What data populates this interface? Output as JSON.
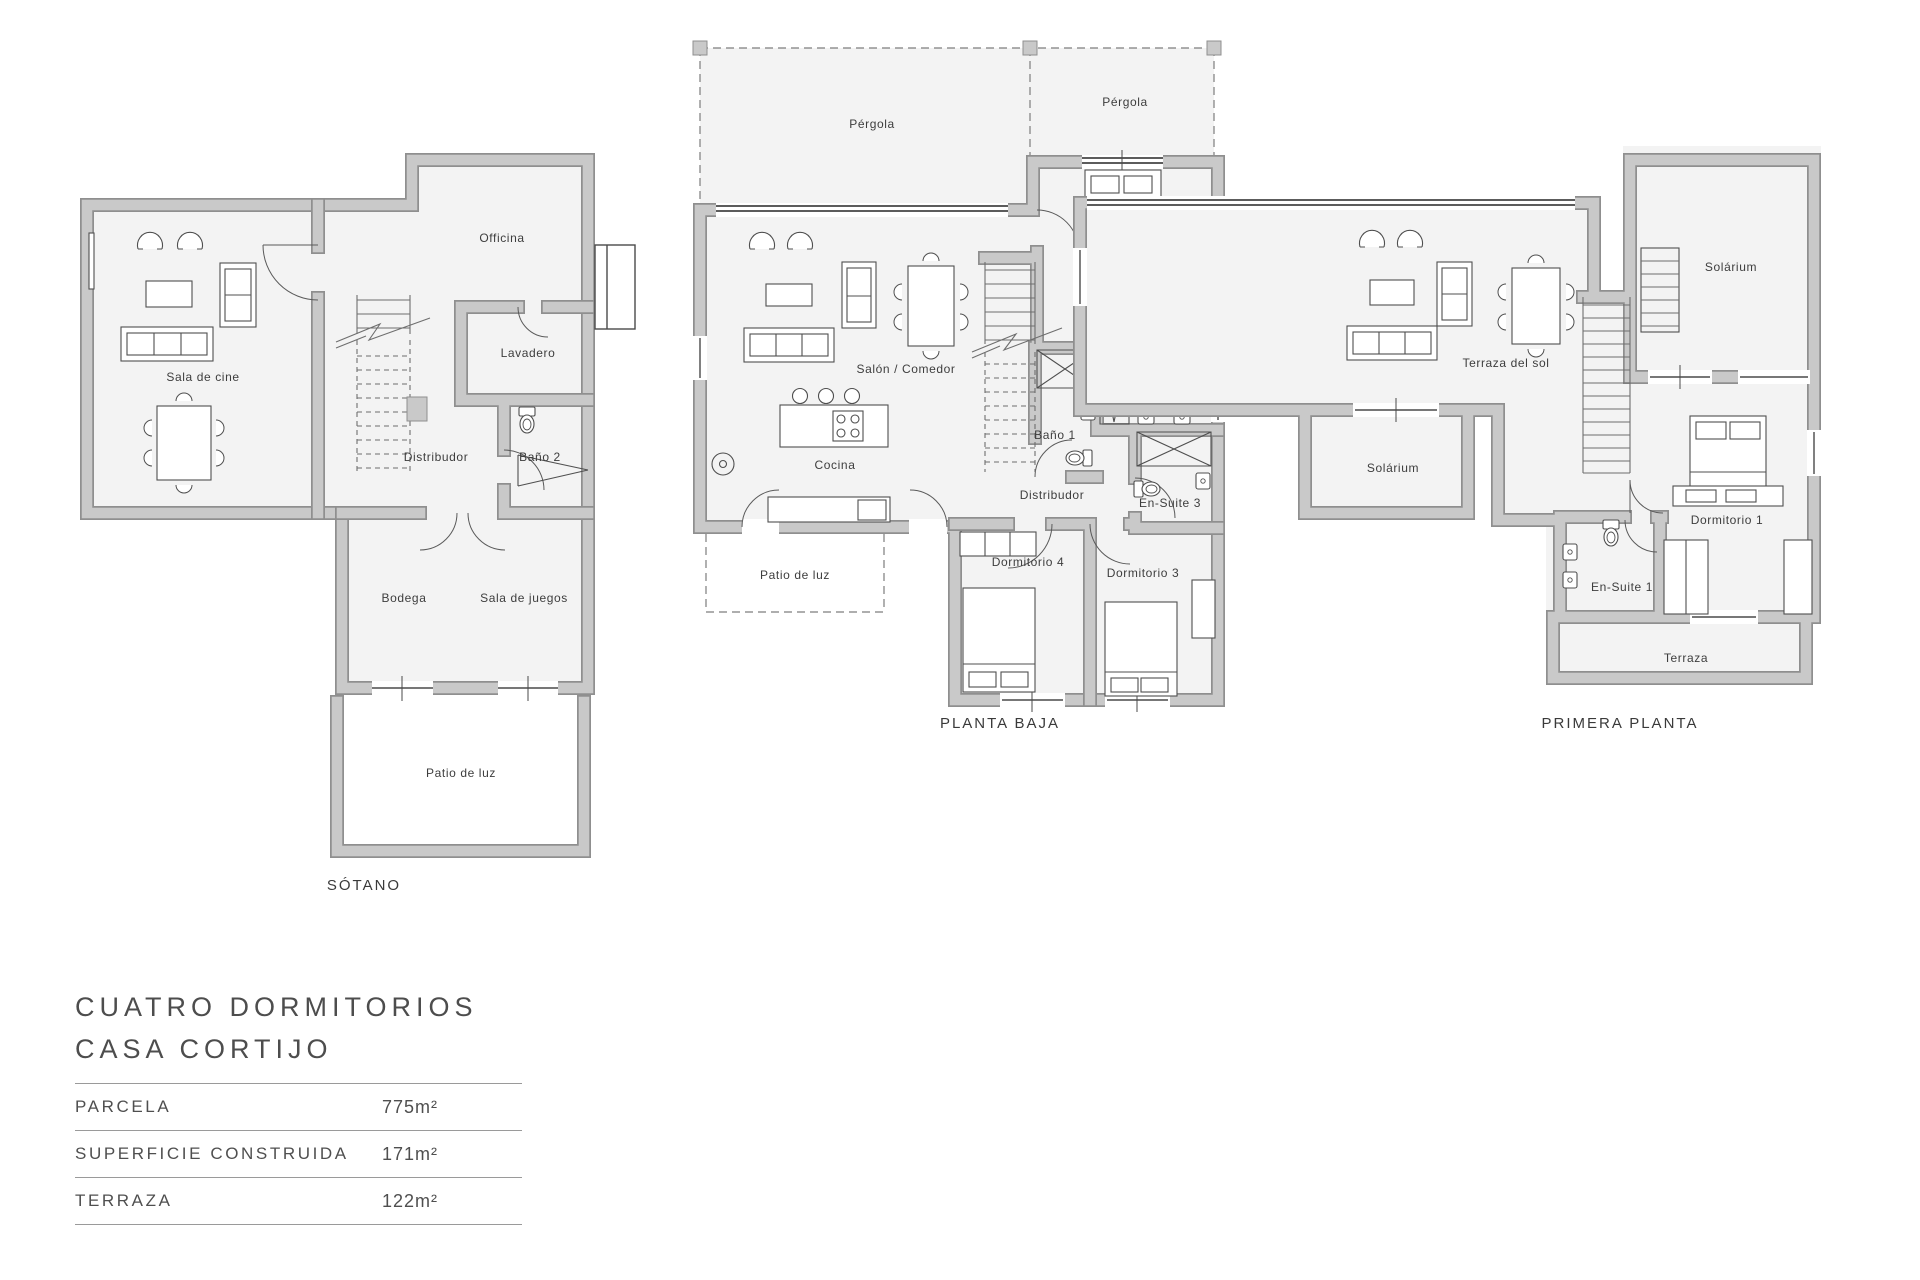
{
  "colors": {
    "wall_fill": "#c9c9c9",
    "wall_edge": "#8f8f8f",
    "floor_fill": "#f3f3f3",
    "line": "#4f4f4f",
    "text": "#3d3d3d"
  },
  "plans": {
    "sotano": {
      "name": "SÓTANO",
      "rooms": {
        "sala_de_cine": "Sala de cine",
        "officina": "Officina",
        "lavadero": "Lavadero",
        "distribudor": "Distribudor",
        "bano2": "Baño 2",
        "bodega": "Bodega",
        "sala_de_juegos": "Sala de juegos",
        "patio_de_luz": "Patio de luz"
      }
    },
    "planta_baja": {
      "name": "PLANTA BAJA",
      "rooms": {
        "pergola_left": "Pérgola",
        "pergola_right": "Pérgola",
        "salon_comedor": "Salón / Comedor",
        "cocina": "Cocina",
        "dormitorio2": "Dormitorio 2",
        "ensuite2": "En-Suite 2",
        "bano1": "Baño 1",
        "distribudor": "Distribudor",
        "ensuite3": "En-Suite 3",
        "dormitorio4": "Dormitorio 4",
        "dormitorio3": "Dormitorio 3",
        "patio_de_luz": "Patio de luz"
      }
    },
    "primera_planta": {
      "name": "PRIMERA PLANTA",
      "rooms": {
        "terraza_del_sol": "Terraza del sol",
        "solarium_top": "Solárium",
        "solarium_left": "Solárium",
        "dormitorio1": "Dormitorio 1",
        "ensuite1": "En-Suite 1",
        "terraza": "Terraza"
      }
    }
  },
  "info": {
    "title_line1": "CUATRO DORMITORIOS",
    "title_line2": "CASA CORTIJO",
    "specs": [
      {
        "label": "PARCELA",
        "value": "775m²"
      },
      {
        "label": "SUPERFICIE CONSTRUIDA",
        "value": "171m²"
      },
      {
        "label": "TERRAZA",
        "value": "122m²"
      }
    ]
  }
}
